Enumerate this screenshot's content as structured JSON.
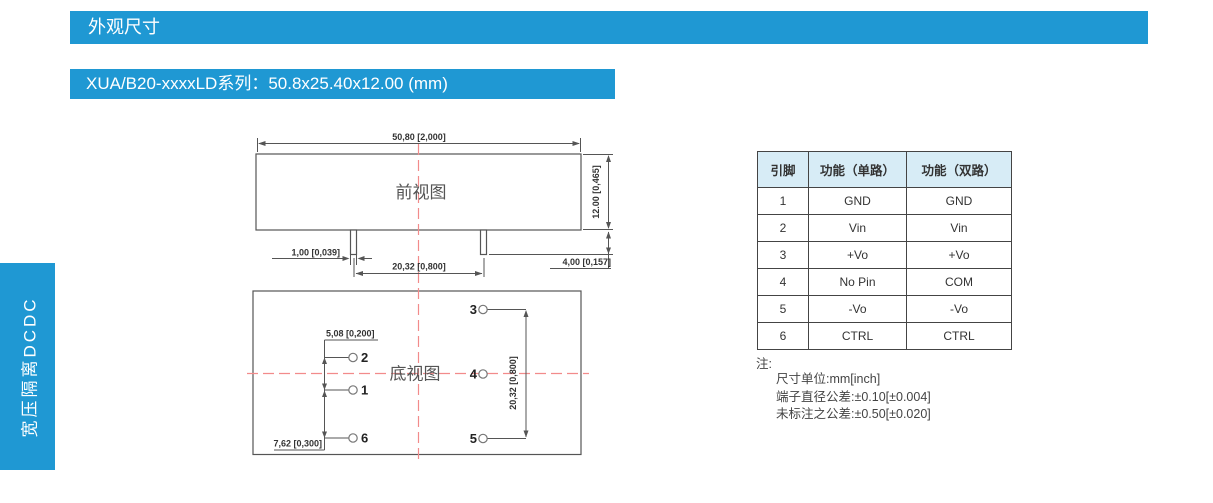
{
  "page": {
    "section_title": "外观尺寸",
    "series_title": "XUA/B20-xxxxLD系列：50.8x25.40x12.00 (mm)",
    "sidebar_label": "宽压隔离DCDC"
  },
  "drawing": {
    "front_view": {
      "label": "前视图",
      "dim_width": "50,80 [2,000]",
      "dim_height": "12.00 [0,465]",
      "dim_pin_width": "1,00 [0,039]",
      "dim_pin_pitch": "20,32 [0,800]",
      "dim_pin_length": "4,00 [0,157]"
    },
    "bottom_view": {
      "label": "底视图",
      "dim_pin_offset_small": "5,08 [0,200]",
      "dim_pin_offset_large": "7,62 [0,300]",
      "dim_pin_pitch": "20,32 [0,800]",
      "pins": {
        "p1": "1",
        "p2": "2",
        "p3": "3",
        "p4": "4",
        "p5": "5",
        "p6": "6"
      }
    }
  },
  "pin_table": {
    "headers": [
      "引脚",
      "功能（单路）",
      "功能（双路）"
    ],
    "rows": [
      {
        "pin": "1",
        "single": "GND",
        "dual": "GND"
      },
      {
        "pin": "2",
        "single": "Vin",
        "dual": "Vin"
      },
      {
        "pin": "3",
        "single": "+Vo",
        "dual": "+Vo"
      },
      {
        "pin": "4",
        "single": "No Pin",
        "dual": "COM"
      },
      {
        "pin": "5",
        "single": "-Vo",
        "dual": "-Vo"
      },
      {
        "pin": "6",
        "single": "CTRL",
        "dual": "CTRL"
      }
    ]
  },
  "notes": {
    "title": "注:",
    "lines": [
      "尺寸单位:mm[inch]",
      "端子直径公差:±0.10[±0.004]",
      "未标注之公差:±0.50[±0.020]"
    ]
  },
  "colors": {
    "accent_blue": "#1f98d3",
    "table_header_bg": "#d7ecf6",
    "centerline_red": "#f28b8b",
    "line_gray": "#555555",
    "text_dark": "#333333"
  }
}
